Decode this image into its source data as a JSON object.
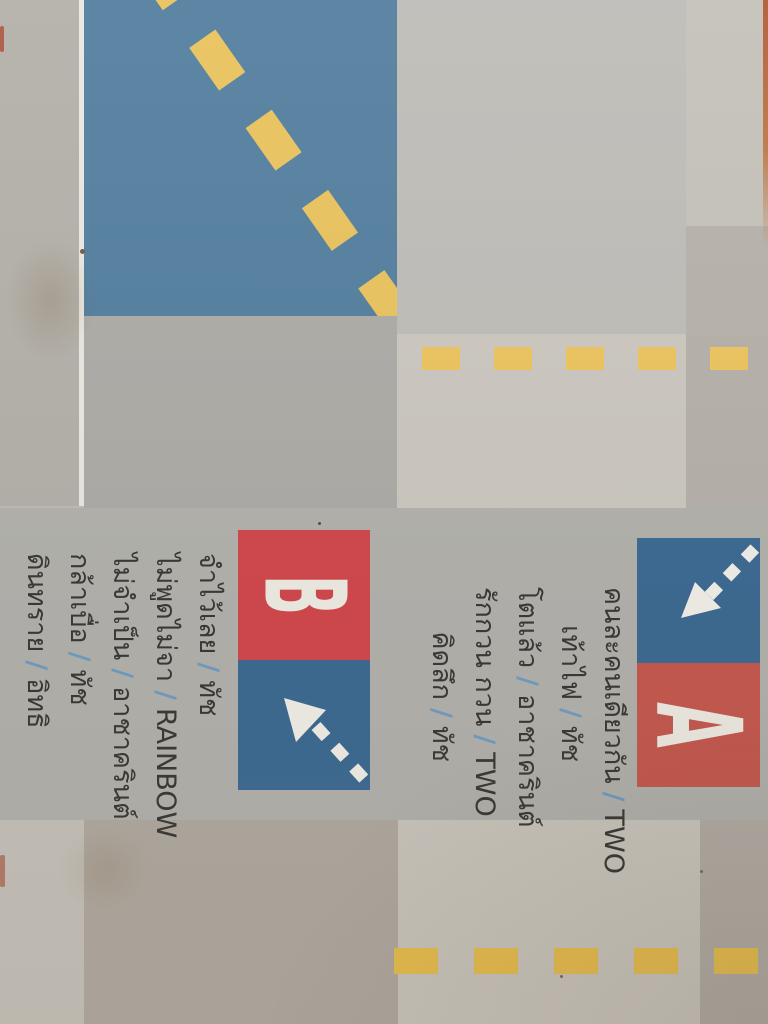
{
  "cassette": {
    "separator": "/",
    "side_a": {
      "label": "A",
      "tracks": [
        {
          "title": "คนละคนเดียวกัน",
          "artist": "TWO"
        },
        {
          "title": "เท้าไฟ",
          "artist": "ทัช"
        },
        {
          "title": "โตแล้ว",
          "artist": "อาชาครินต์"
        },
        {
          "title": "รักกวน กวน",
          "artist": "TWO"
        },
        {
          "title": "คิดลึก",
          "artist": "ทัช"
        }
      ]
    },
    "side_b": {
      "label": "B",
      "tracks": [
        {
          "title": "จำไว้เลย",
          "artist": "ทัช"
        },
        {
          "title": "ไม่พูดไม่จา",
          "artist": "RAINBOW"
        },
        {
          "title": "ไม่จำเป็น",
          "artist": "อาชาครินต์"
        },
        {
          "title": "กล้าเบื่อ",
          "artist": "ทัช"
        },
        {
          "title": "ดินทราย",
          "artist": "อิทธิ"
        }
      ]
    }
  },
  "colors": {
    "paper": "#bfbcb5",
    "blue": "#54809f",
    "blue2": "#3e6b93",
    "red": "#d2494e",
    "red2": "#c65a50",
    "yellow": "#edc45f",
    "slash": "#6f9ec2",
    "text": "#3b3a36"
  }
}
